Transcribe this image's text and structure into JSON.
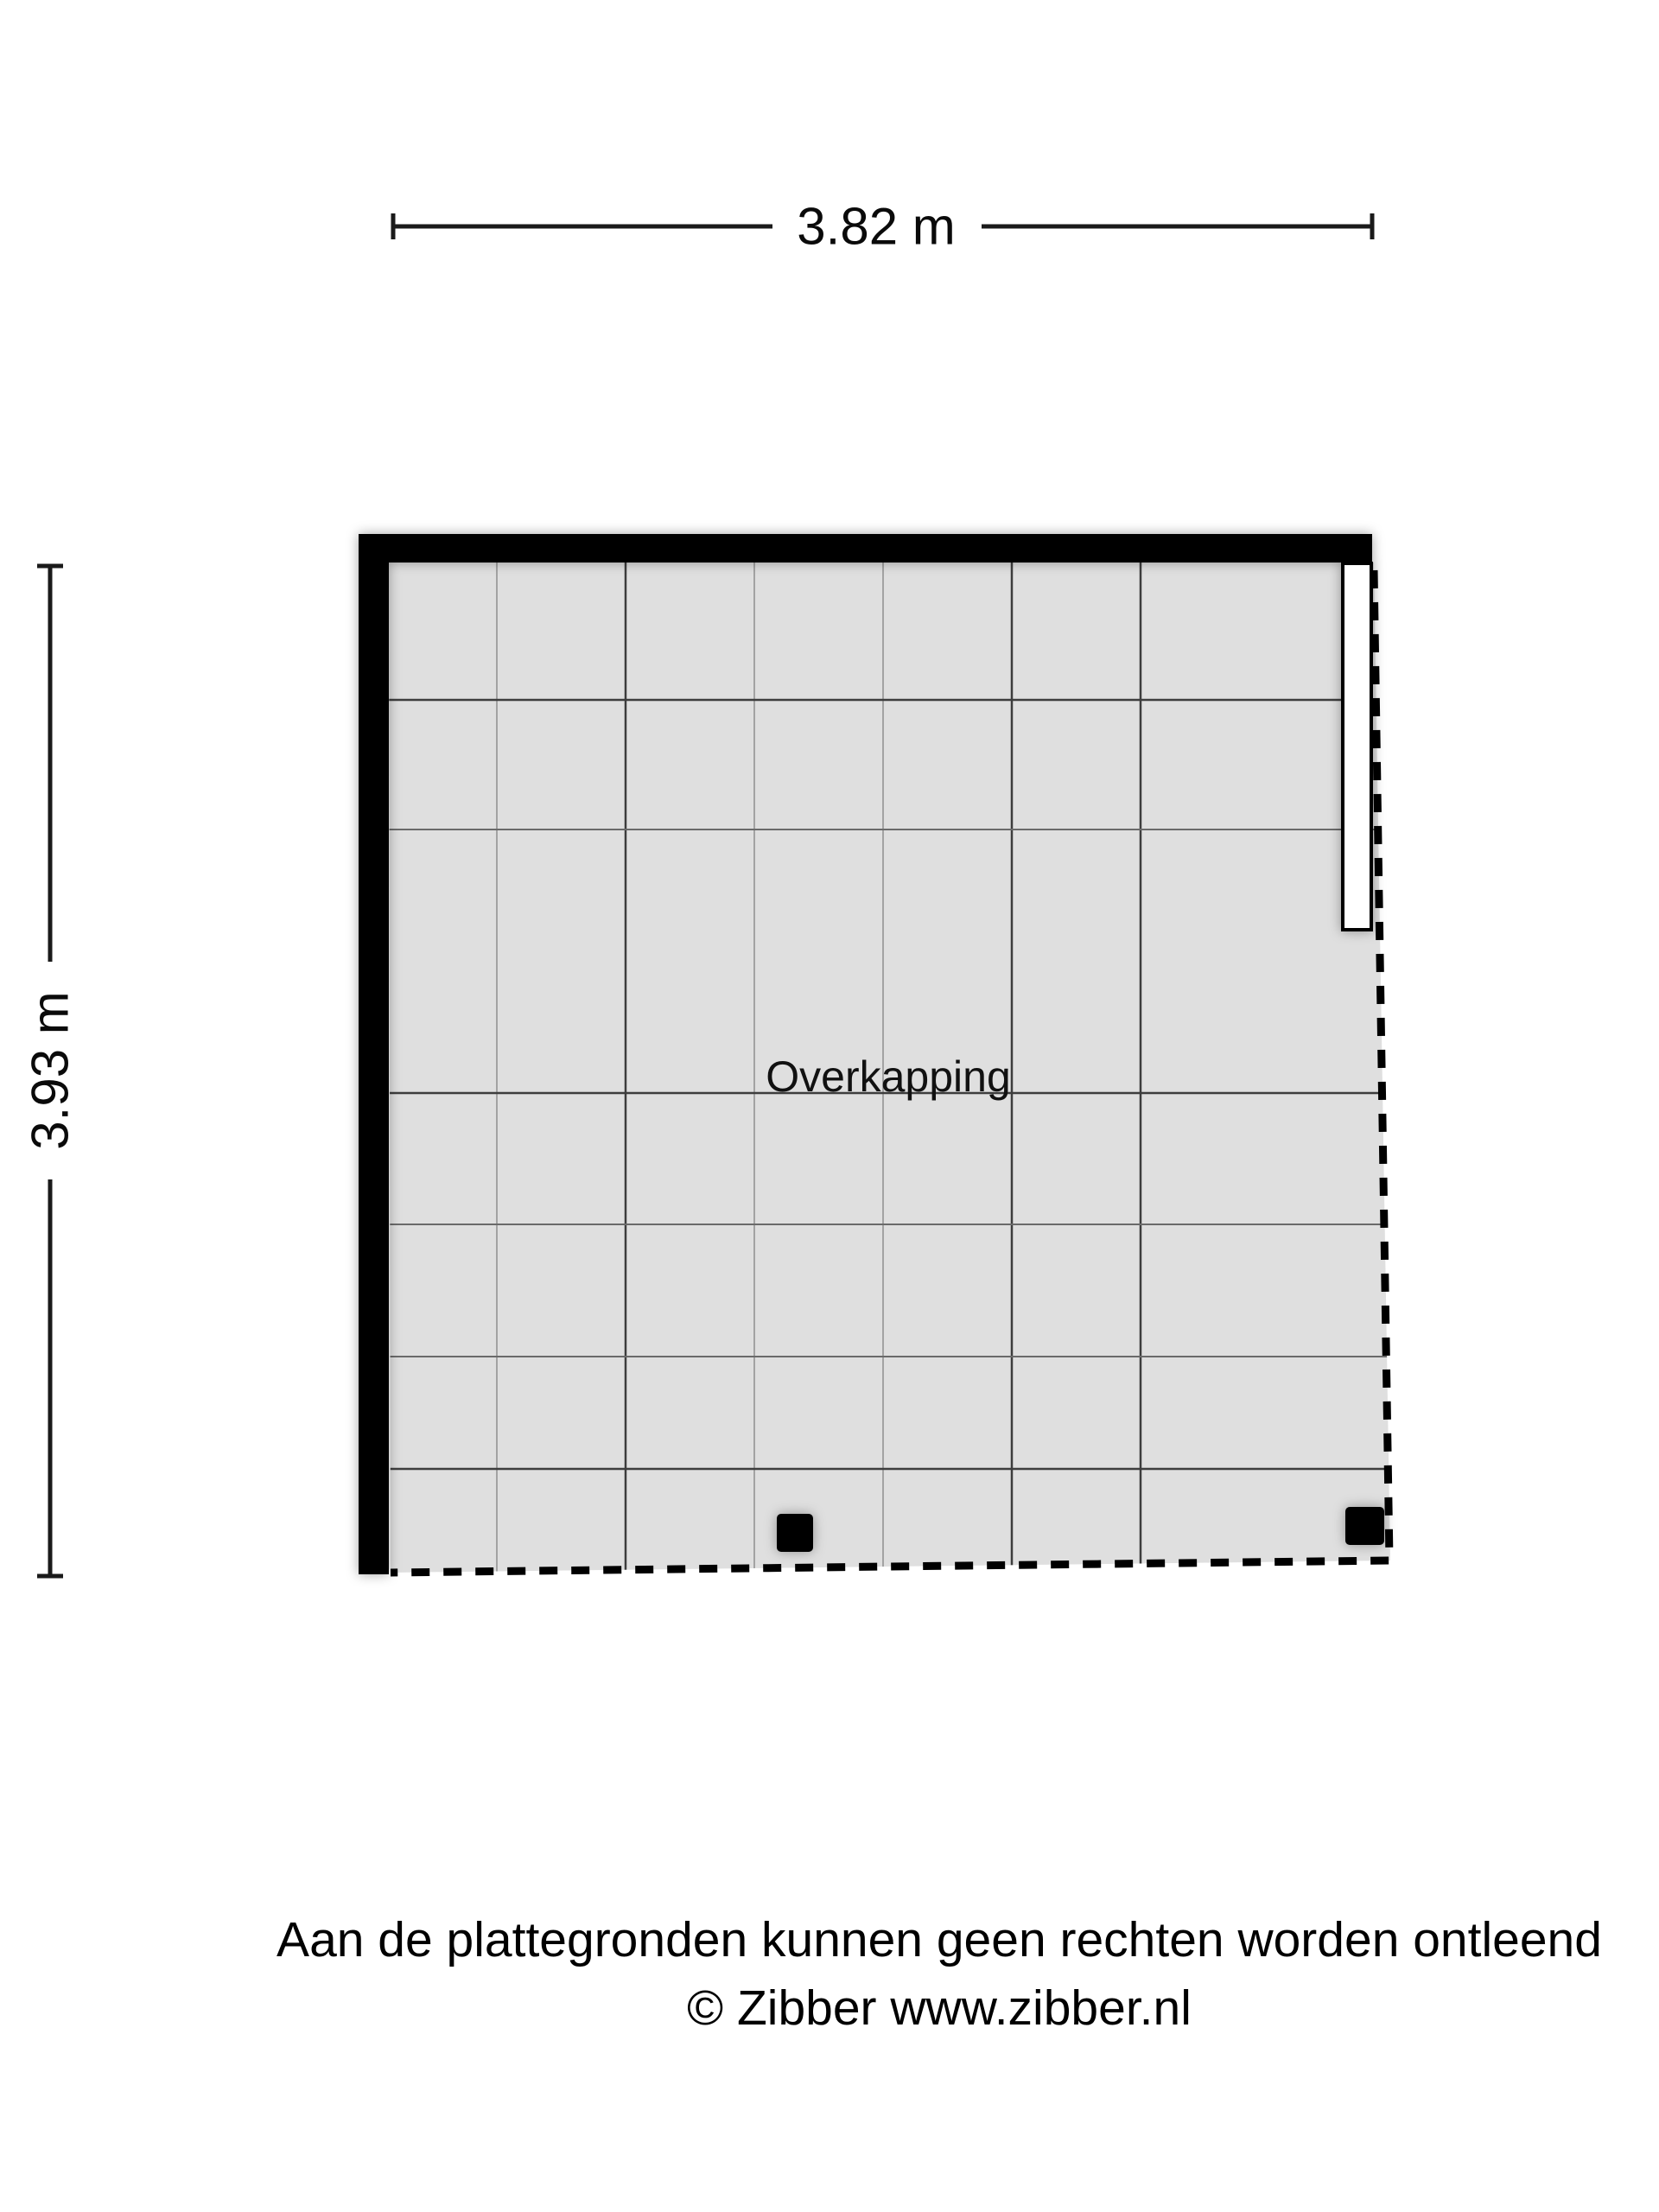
{
  "dimensions": {
    "width_label": "3.82 m",
    "height_label": "3.93 m"
  },
  "room": {
    "label": "Overkapping"
  },
  "footer": {
    "disclaimer": "Aan de plattegronden kunnen geen rechten worden ontleend",
    "copyright": "© Zibber www.zibber.nl"
  },
  "colors": {
    "background": "#ffffff",
    "floor": "#dfdfdf",
    "wall": "#000000",
    "beam_fill": "#ffffff",
    "post": "#000000",
    "text": "#000000"
  }
}
